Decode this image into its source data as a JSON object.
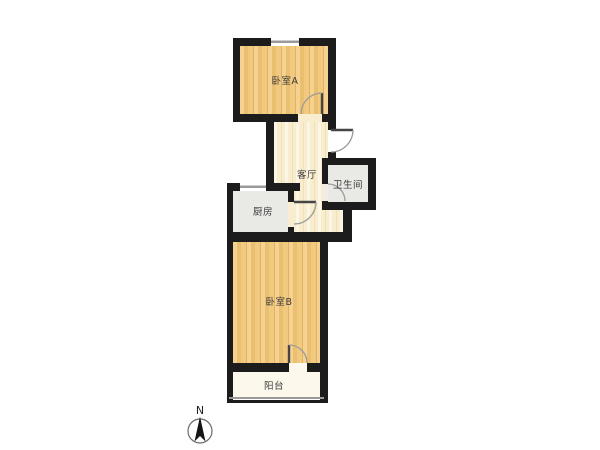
{
  "plan": {
    "rooms": {
      "bedroom_a": {
        "label": "卧室A"
      },
      "living_room": {
        "label": "客厅"
      },
      "bathroom": {
        "label": "卫生间"
      },
      "kitchen": {
        "label": "厨房"
      },
      "bedroom_b": {
        "label": "卧室B"
      },
      "balcony": {
        "label": "阳台"
      }
    },
    "compass": {
      "north_label": "N"
    },
    "colors": {
      "wall": "#1c1c1c",
      "wood_floor": "#efc57c",
      "living_floor": "#f8eecf",
      "tile_floor": "#e9e9e5",
      "balcony_floor": "#fcf8ec"
    }
  }
}
